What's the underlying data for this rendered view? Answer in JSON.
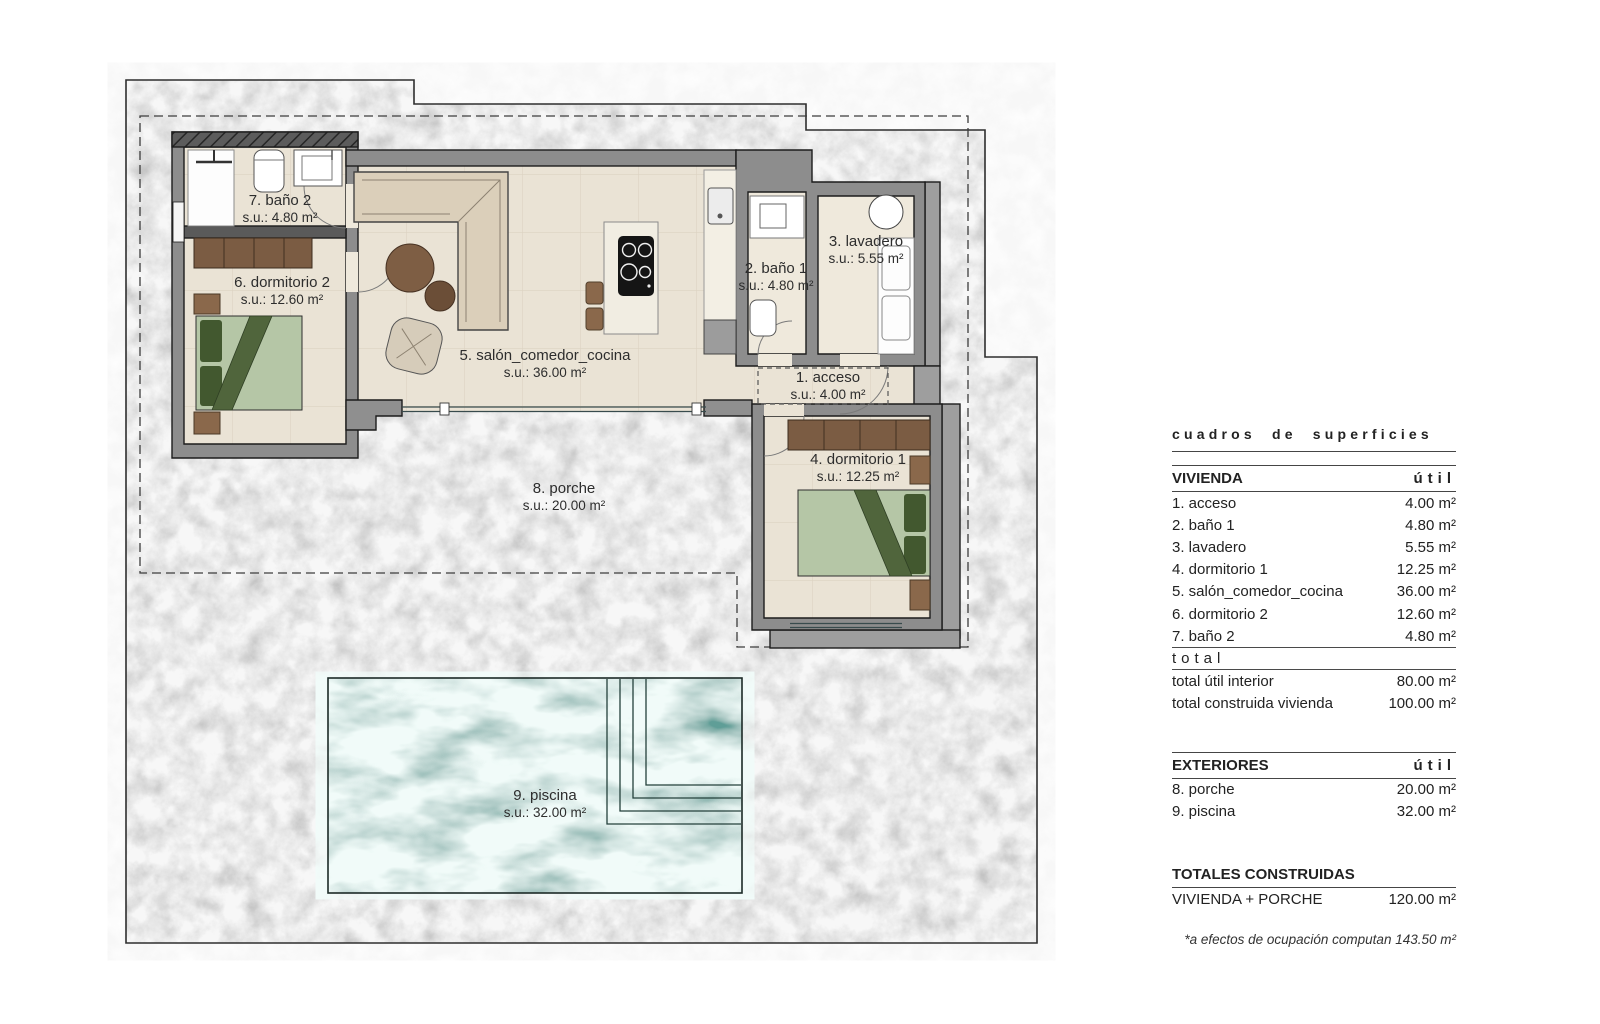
{
  "plan": {
    "labels": [
      {
        "id": "banyo2",
        "name": "7. baño 2",
        "su": "s.u.: 4.80 m²"
      },
      {
        "id": "dormitorio2",
        "name": "6. dormitorio 2",
        "su": "s.u.: 12.60 m²"
      },
      {
        "id": "salon",
        "name": "5. salón_comedor_cocina",
        "su": "s.u.: 36.00 m²"
      },
      {
        "id": "banyo1",
        "name": "2. baño 1",
        "su": "s.u.: 4.80 m²"
      },
      {
        "id": "lavadero",
        "name": "3. lavadero",
        "su": "s.u.: 5.55 m²"
      },
      {
        "id": "acceso",
        "name": "1. acceso",
        "su": "s.u.: 4.00 m²"
      },
      {
        "id": "dormitorio1",
        "name": "4. dormitorio 1",
        "su": "s.u.: 12.25 m²"
      },
      {
        "id": "porche",
        "name": "8. porche",
        "su": "s.u.: 20.00 m²"
      },
      {
        "id": "piscina",
        "name": "9. piscina",
        "su": "s.u.: 32.00 m²"
      }
    ]
  },
  "panel": {
    "title": "cuadros de superficies",
    "vivienda": {
      "header": "VIVIENDA",
      "unit": "útil",
      "rows": [
        {
          "label": "1. acceso",
          "value": "4.00 m²"
        },
        {
          "label": "2. baño 1",
          "value": "4.80 m²"
        },
        {
          "label": "3. lavadero",
          "value": "5.55 m²"
        },
        {
          "label": "4. dormitorio 1",
          "value": "12.25 m²"
        },
        {
          "label": "5. salón_comedor_cocina",
          "value": "36.00 m²"
        },
        {
          "label": "6. dormitorio 2",
          "value": "12.60 m²"
        },
        {
          "label": "7. baño 2",
          "value": "4.80 m²"
        }
      ],
      "total_divider": "total",
      "totals": [
        {
          "label": "total útil interior",
          "value": "80.00 m²"
        },
        {
          "label": "total construida vivienda",
          "value": "100.00 m²"
        }
      ]
    },
    "exteriores": {
      "header": "EXTERIORES",
      "unit": "útil",
      "rows": [
        {
          "label": "8. porche",
          "value": "20.00 m²"
        },
        {
          "label": "9. piscina",
          "value": "32.00 m²"
        }
      ]
    },
    "totales": {
      "header": "TOTALES CONSTRUIDAS",
      "rows": [
        {
          "label": "VIVIENDA + PORCHE",
          "value": "120.00 m²"
        }
      ]
    },
    "footnote": "*a efectos de ocupación computan 143.50 m²"
  },
  "colors": {
    "concrete": "#c3c3c3",
    "wall_outer": "#8d8d8d",
    "wall_inner": "#5a5a5a",
    "floor": "#eae3d5",
    "pool": "#5f9e97",
    "wood": "#7b5c43",
    "bed": "#b5c6a6",
    "bed_dark": "#42582f"
  }
}
